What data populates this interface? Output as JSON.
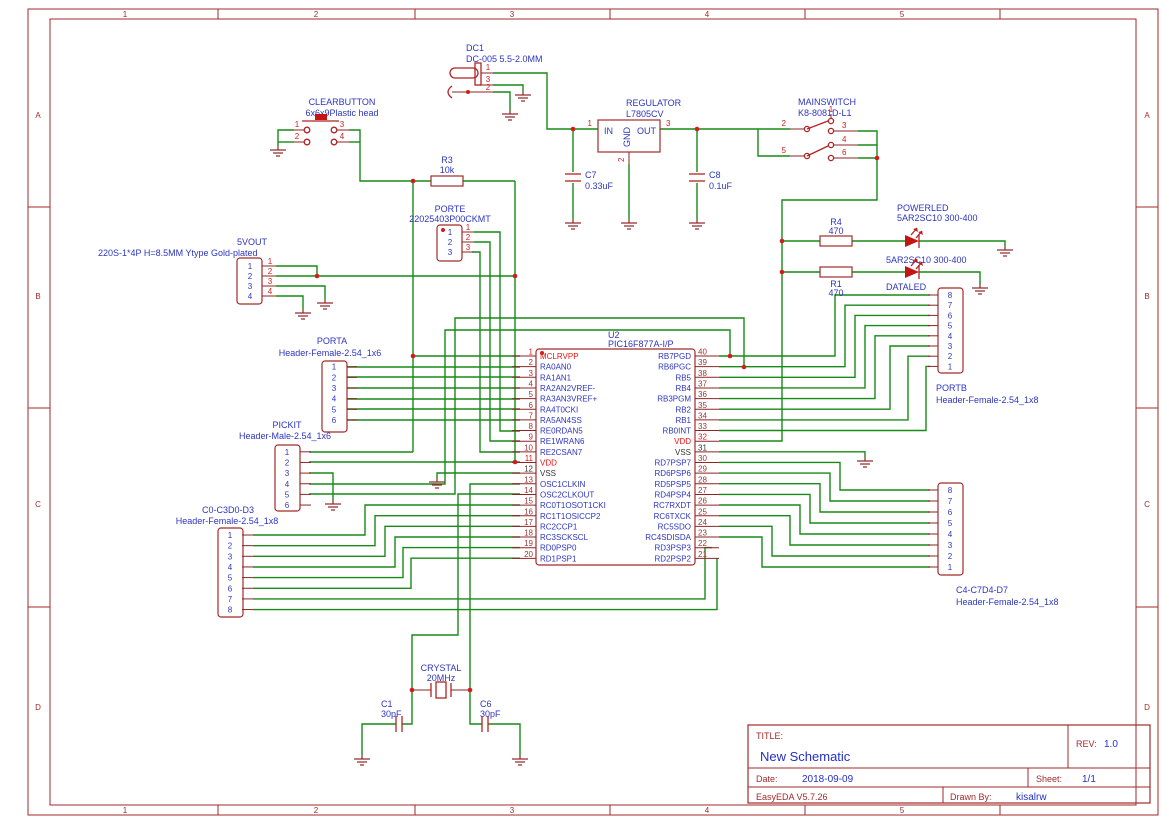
{
  "frame": {
    "cols": [
      "1",
      "2",
      "3",
      "4",
      "5"
    ],
    "rows": [
      "A",
      "B",
      "C",
      "D"
    ]
  },
  "title_block": {
    "title_label": "TITLE:",
    "title": "New Schematic",
    "rev_label": "REV:",
    "rev": "1.0",
    "date_label": "Date:",
    "date": "2018-09-09",
    "sheet_label": "Sheet:",
    "sheet": "1/1",
    "tool": "EasyEDA V5.7.26",
    "drawn_by_label": "Drawn By:",
    "drawn_by": "kisalrw"
  },
  "parts": {
    "dc1": {
      "ref": "DC1",
      "model": "DC-005 5.5-2.0MM",
      "p1": "1",
      "p2": "2",
      "p3": "3"
    },
    "clearbutton": {
      "ref": "CLEARBUTTON",
      "model": "6x6x9Plastic head",
      "p1": "1",
      "p2": "2",
      "p3": "3",
      "p4": "4"
    },
    "regulator": {
      "ref": "REGULATOR",
      "model": "L7805CV",
      "in": "IN",
      "out": "OUT",
      "gnd": "GND",
      "p1": "1",
      "p2": "2",
      "p3": "3"
    },
    "mainswitch": {
      "ref": "MAINSWITCH",
      "model": "K8-8081D-L1",
      "p1": "1",
      "p2": "2",
      "p3": "3",
      "p4": "4",
      "p5": "5",
      "p6": "6"
    },
    "r3": {
      "ref": "R3",
      "value": "10k"
    },
    "r4": {
      "ref": "R4",
      "value": "470"
    },
    "r1": {
      "ref": "R1",
      "value": "470"
    },
    "c7": {
      "ref": "C7",
      "value": "0.33uF"
    },
    "c8": {
      "ref": "C8",
      "value": "0.1uF"
    },
    "c1": {
      "ref": "C1",
      "value": "30pF"
    },
    "c6": {
      "ref": "C6",
      "value": "30pF"
    },
    "crystal": {
      "ref": "CRYSTAL",
      "value": "20MHz"
    },
    "powerled": {
      "ref": "POWERLED",
      "model": "5AR2SC10 300-400"
    },
    "dataled": {
      "ref": "DATALED",
      "model": "5AR2SC10 300-400"
    },
    "vout5": {
      "ref": "5VOUT",
      "model": "220S-1*4P H=8.5MM Ytype Gold-plated",
      "pins": [
        {
          "n": "1"
        },
        {
          "n": "2"
        },
        {
          "n": "3"
        },
        {
          "n": "4"
        }
      ]
    },
    "porte": {
      "ref": "PORTE",
      "model": "22025403P00CKMT",
      "pins": [
        {
          "n": "1"
        },
        {
          "n": "2"
        },
        {
          "n": "3"
        }
      ]
    },
    "porta": {
      "ref": "PORTA",
      "model": "Header-Female-2.54_1x6",
      "pins": [
        {
          "n": "1"
        },
        {
          "n": "2"
        },
        {
          "n": "3"
        },
        {
          "n": "4"
        },
        {
          "n": "5"
        },
        {
          "n": "6"
        }
      ]
    },
    "pickit": {
      "ref": "PICKIT",
      "model": "Header-Male-2.54_1x6",
      "pins": [
        {
          "n": "1"
        },
        {
          "n": "2"
        },
        {
          "n": "3"
        },
        {
          "n": "4"
        },
        {
          "n": "5"
        },
        {
          "n": "6"
        }
      ]
    },
    "c0c3": {
      "ref": "C0-C3D0-D3",
      "model": "Header-Female-2.54_1x8",
      "pins": [
        {
          "n": "1"
        },
        {
          "n": "2"
        },
        {
          "n": "3"
        },
        {
          "n": "4"
        },
        {
          "n": "5"
        },
        {
          "n": "6"
        },
        {
          "n": "7"
        },
        {
          "n": "8"
        }
      ]
    },
    "portb": {
      "ref": "PORTB",
      "model": "Header-Female-2.54_1x8",
      "pins": [
        {
          "n": "8"
        },
        {
          "n": "7"
        },
        {
          "n": "6"
        },
        {
          "n": "5"
        },
        {
          "n": "4"
        },
        {
          "n": "3"
        },
        {
          "n": "2"
        },
        {
          "n": "1"
        }
      ]
    },
    "c4c7": {
      "ref": "C4-C7D4-D7",
      "model": "Header-Female-2.54_1x8",
      "pins": [
        {
          "n": "8"
        },
        {
          "n": "7"
        },
        {
          "n": "6"
        },
        {
          "n": "5"
        },
        {
          "n": "4"
        },
        {
          "n": "3"
        },
        {
          "n": "2"
        },
        {
          "n": "1"
        }
      ]
    },
    "u2": {
      "ref": "U2",
      "model": "PIC16F877A-I/P",
      "left_pins": [
        {
          "n": "1",
          "name": "MCLRVPP",
          "t": "v"
        },
        {
          "n": "2",
          "name": "RA0AN0",
          "t": ""
        },
        {
          "n": "3",
          "name": "RA1AN1",
          "t": ""
        },
        {
          "n": "4",
          "name": "RA2AN2VREF-",
          "t": ""
        },
        {
          "n": "5",
          "name": "RA3AN3VREF+",
          "t": ""
        },
        {
          "n": "6",
          "name": "RA4T0CKI",
          "t": ""
        },
        {
          "n": "7",
          "name": "RA5AN4SS",
          "t": ""
        },
        {
          "n": "8",
          "name": "RE0RDAN5",
          "t": ""
        },
        {
          "n": "9",
          "name": "RE1WRAN6",
          "t": ""
        },
        {
          "n": "10",
          "name": "RE2CSAN7",
          "t": ""
        },
        {
          "n": "11",
          "name": "VDD",
          "t": "v"
        },
        {
          "n": "12",
          "name": "VSS",
          "t": "g"
        },
        {
          "n": "13",
          "name": "OSC1CLKIN",
          "t": ""
        },
        {
          "n": "14",
          "name": "OSC2CLKOUT",
          "t": ""
        },
        {
          "n": "15",
          "name": "RC0T1OSOT1CKI",
          "t": ""
        },
        {
          "n": "16",
          "name": "RC1T1OSICCP2",
          "t": ""
        },
        {
          "n": "17",
          "name": "RC2CCP1",
          "t": ""
        },
        {
          "n": "18",
          "name": "RC3SCKSCL",
          "t": ""
        },
        {
          "n": "19",
          "name": "RD0PSP0",
          "t": ""
        },
        {
          "n": "20",
          "name": "RD1PSP1",
          "t": ""
        }
      ],
      "right_pins": [
        {
          "n": "40",
          "name": "RB7PGD",
          "t": ""
        },
        {
          "n": "39",
          "name": "RB6PGC",
          "t": ""
        },
        {
          "n": "38",
          "name": "RB5",
          "t": ""
        },
        {
          "n": "37",
          "name": "RB4",
          "t": ""
        },
        {
          "n": "36",
          "name": "RB3PGM",
          "t": ""
        },
        {
          "n": "35",
          "name": "RB2",
          "t": ""
        },
        {
          "n": "34",
          "name": "RB1",
          "t": ""
        },
        {
          "n": "33",
          "name": "RB0INT",
          "t": ""
        },
        {
          "n": "32",
          "name": "VDD",
          "t": "v"
        },
        {
          "n": "31",
          "name": "VSS",
          "t": "g"
        },
        {
          "n": "30",
          "name": "RD7PSP7",
          "t": ""
        },
        {
          "n": "29",
          "name": "RD6PSP6",
          "t": ""
        },
        {
          "n": "28",
          "name": "RD5PSP5",
          "t": ""
        },
        {
          "n": "27",
          "name": "RD4PSP4",
          "t": ""
        },
        {
          "n": "26",
          "name": "RC7RXDT",
          "t": ""
        },
        {
          "n": "25",
          "name": "RC6TXCK",
          "t": ""
        },
        {
          "n": "24",
          "name": "RC5SDO",
          "t": ""
        },
        {
          "n": "23",
          "name": "RC4SDISDA",
          "t": ""
        },
        {
          "n": "22",
          "name": "RD3PSP3",
          "t": ""
        },
        {
          "n": "21",
          "name": "RD2PSP2",
          "t": ""
        }
      ]
    }
  }
}
